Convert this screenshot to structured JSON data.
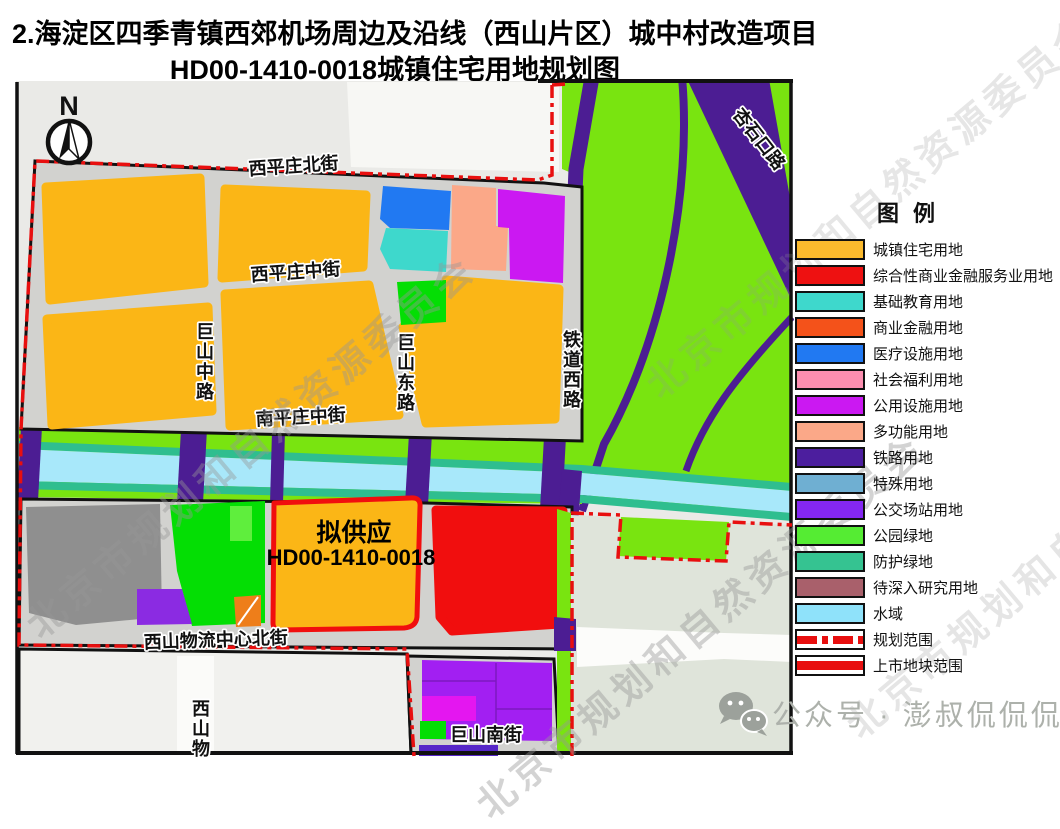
{
  "title": {
    "line1": "2.海淀区四季青镇西郊机场周边及沿线（西山片区）城中村改造项目",
    "line2": "HD00-1410-0018城镇住宅用地规划图"
  },
  "map": {
    "compass": "N",
    "streets": {
      "xipingzhuang_north": "西平庄北街",
      "xipingzhuang_middle": "西平庄中街",
      "nanpingzhuang_middle": "南平庄中街",
      "jushan_middle_rd": "巨山中路",
      "jushan_east_rd": "巨山东路",
      "tiedao_west_rd": "铁道西路",
      "xishan_logistics_north": "西山物流中心北街",
      "jushan_south": "巨山南街",
      "xishan_partial": "西山物",
      "xingshikou_rd": "杏石口路"
    },
    "highlight": {
      "line1": "拟供应",
      "line2": "HD00-1410-0018"
    },
    "watermark": "北京市规划和自然资源委员会"
  },
  "legend": {
    "title": "图例",
    "items": [
      {
        "label": "城镇住宅用地",
        "color": "#FBBA2D",
        "type": "fill"
      },
      {
        "label": "综合性商业金融服务业用地",
        "color": "#EE1111",
        "type": "fill"
      },
      {
        "label": "基础教育用地",
        "color": "#3ED8CC",
        "type": "fill"
      },
      {
        "label": "商业金融用地",
        "color": "#F4521A",
        "type": "fill"
      },
      {
        "label": "医疗设施用地",
        "color": "#2179F2",
        "type": "fill"
      },
      {
        "label": "社会福利用地",
        "color": "#FC8EB0",
        "type": "fill"
      },
      {
        "label": "公用设施用地",
        "color": "#CB18F2",
        "type": "fill"
      },
      {
        "label": "多功能用地",
        "color": "#FBA888",
        "type": "fill"
      },
      {
        "label": "铁路用地",
        "color": "#4C1E9E",
        "type": "fill"
      },
      {
        "label": "特殊用地",
        "color": "#6FAFD2",
        "type": "fill"
      },
      {
        "label": "公交场站用地",
        "color": "#8427F2",
        "type": "fill"
      },
      {
        "label": "公园绿地",
        "color": "#55EC33",
        "type": "fill"
      },
      {
        "label": "防护绿地",
        "color": "#35C391",
        "type": "fill"
      },
      {
        "label": "待深入研究用地",
        "color": "#A9606B",
        "type": "fill"
      },
      {
        "label": "水域",
        "color": "#8FE2FA",
        "type": "fill"
      },
      {
        "label": "规划范围",
        "color": "#E80F0F",
        "type": "dashline"
      },
      {
        "label": "上市地块范围",
        "color": "#E80F0F",
        "type": "solidline"
      }
    ]
  },
  "footer": {
    "account": "公众号 · 澎叔侃侃侃"
  }
}
